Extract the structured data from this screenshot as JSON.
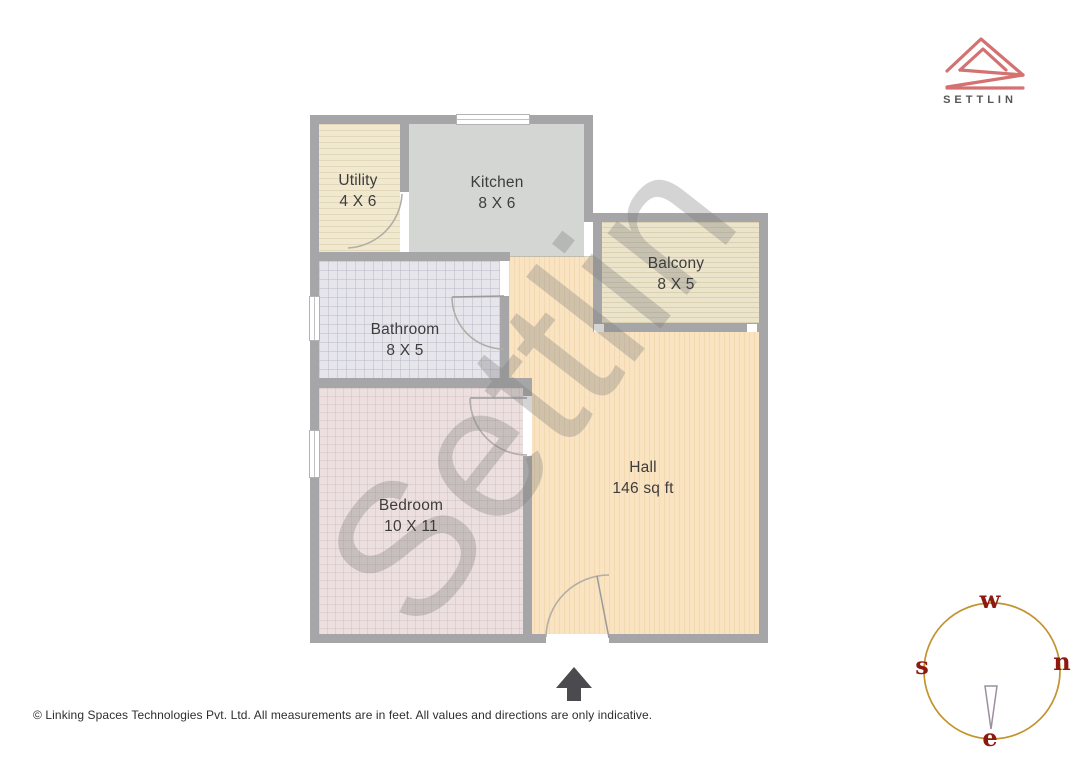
{
  "brand": {
    "name": "SETTLIN"
  },
  "floorplan": {
    "watermark": "Settlin",
    "rooms": [
      {
        "name": "Utility",
        "dimensions": "4 X 6"
      },
      {
        "name": "Kitchen",
        "dimensions": "8 X 6"
      },
      {
        "name": "Balcony",
        "dimensions": "8 X 5"
      },
      {
        "name": "Bathroom",
        "dimensions": "8 X 5"
      },
      {
        "name": "Bedroom",
        "dimensions": "10 X 11"
      },
      {
        "name": "Hall",
        "dimensions": "146 sq ft"
      }
    ]
  },
  "compass": {
    "top": "w",
    "left": "s",
    "right": "n",
    "bottom": "e"
  },
  "footer": {
    "disclaimer": "© Linking Spaces Technologies Pvt. Ltd. All measurements are in feet. All values and directions are only indicative."
  },
  "colors": {
    "logo_accent": "#d47171",
    "compass_ring": "#c2932f",
    "compass_letters": "#8c1a10",
    "wall": "#a6a6a8",
    "hall_floor": "#fae3c0",
    "kitchen_floor": "#d3d6d3"
  }
}
